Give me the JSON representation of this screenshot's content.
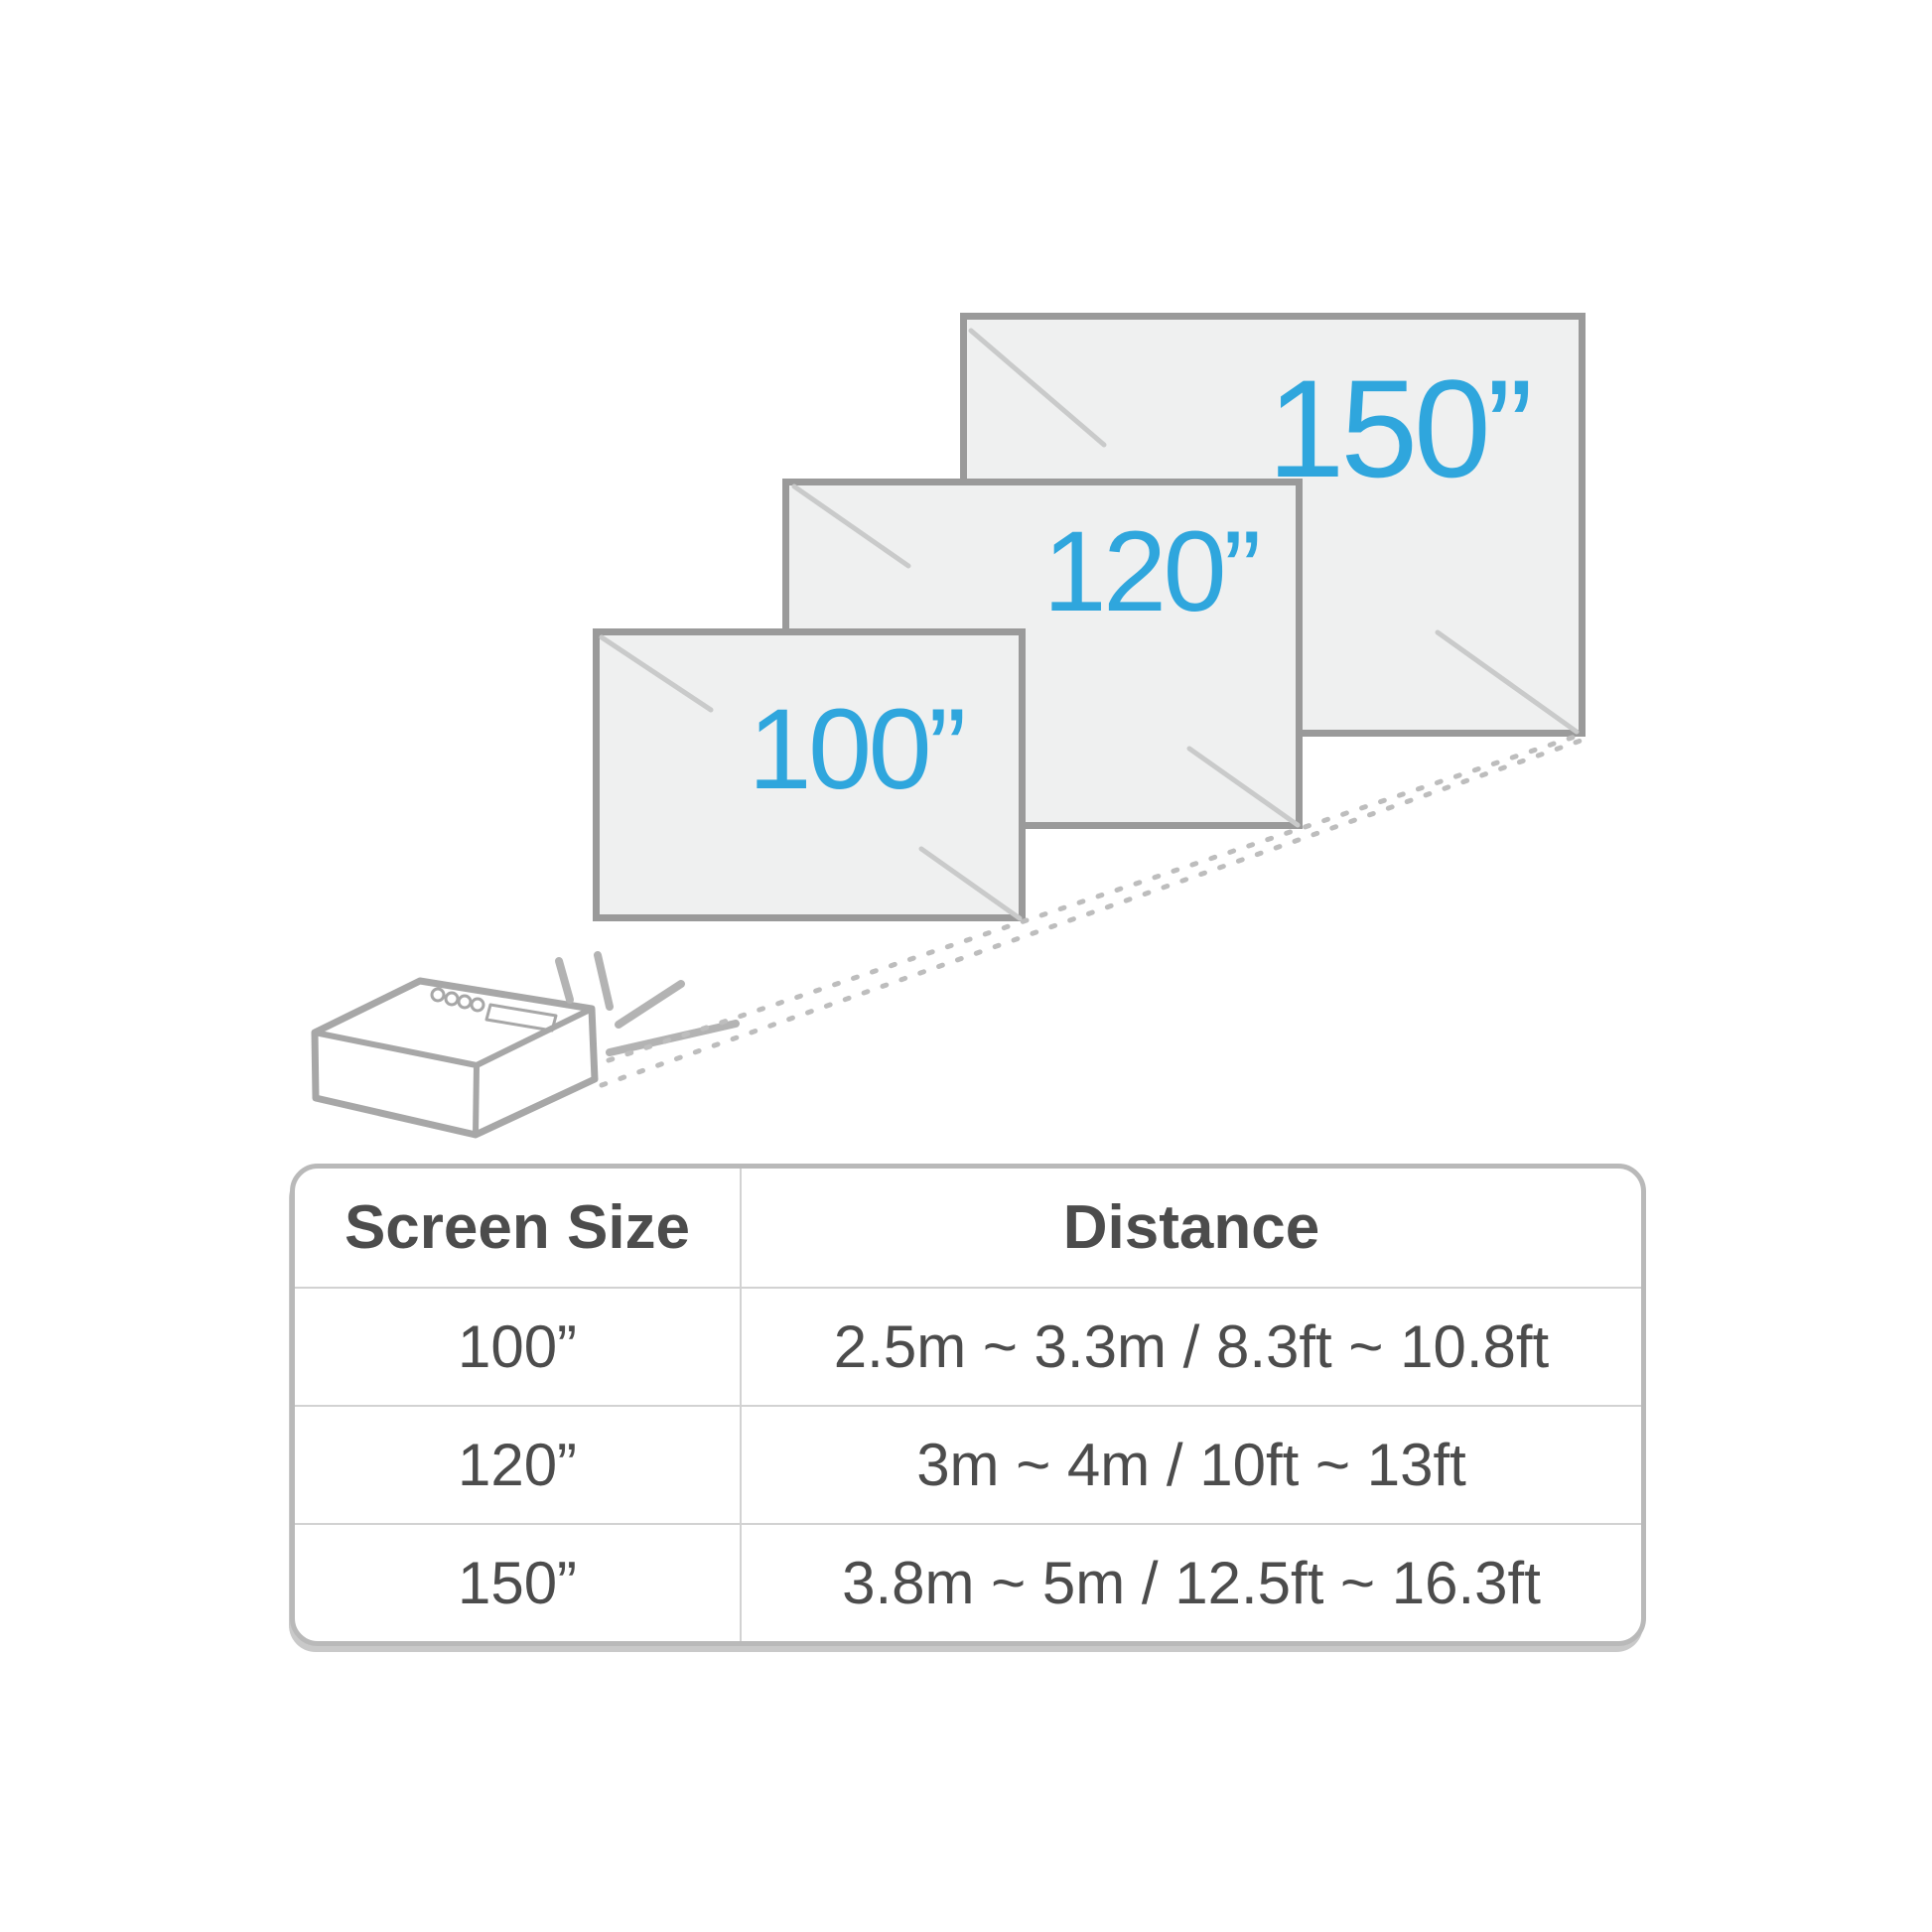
{
  "colors": {
    "accent_blue": "#2FA6DD",
    "screen_fill": "#EFF0F0",
    "screen_border": "#9A9A9A",
    "projector_outline_gray": "#A7A7A7",
    "ray_gray": "#B3B3B3",
    "dotted_beam_gray": "#BDBDBD",
    "shine_gray": "#C9CACA",
    "table_border": "#B9B9B9",
    "table_divider": "#D2D2D2",
    "text_dark": "#4C4C4C",
    "background": "#FFFFFF"
  },
  "screens": [
    {
      "id": "screen-100",
      "label": "100”"
    },
    {
      "id": "screen-120",
      "label": "120”"
    },
    {
      "id": "screen-150",
      "label": "150”"
    }
  ],
  "table": {
    "headers": {
      "screen_size": "Screen Size",
      "distance": "Distance"
    },
    "rows": [
      {
        "size": "100”",
        "distance": "2.5m ~ 3.3m / 8.3ft ~ 10.8ft"
      },
      {
        "size": "120”",
        "distance": "3m ~ 4m / 10ft ~ 13ft"
      },
      {
        "size": "150”",
        "distance": "3.8m ~ 5m / 12.5ft ~ 16.3ft"
      }
    ]
  }
}
